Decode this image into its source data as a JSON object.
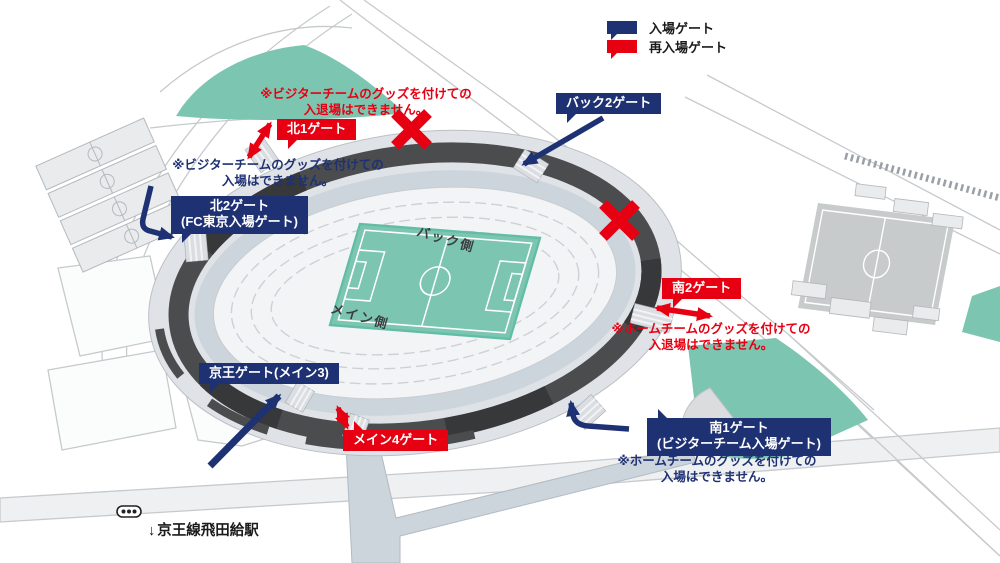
{
  "legend": {
    "entry": "入場ゲート",
    "reentry": "再入場ゲート"
  },
  "gates": {
    "north1": {
      "label": "北1ゲート"
    },
    "north2": {
      "label": "北2ゲート",
      "sublabel": "(FC東京入場ゲート)"
    },
    "back2": {
      "label": "バック2ゲート"
    },
    "south2": {
      "label": "南2ゲート"
    },
    "south1": {
      "label": "南1ゲート",
      "sublabel": "(ビジターチーム入場ゲート)"
    },
    "keio": {
      "label": "京王ゲート(メイン3)"
    },
    "main4": {
      "label": "メイン4ゲート"
    }
  },
  "warnings": {
    "visitor_reentry": {
      "line1": "※ビジターチームのグッズを付けての",
      "line2": "入退場はできません。"
    },
    "visitor_entry": {
      "line1": "※ビジターチームのグッズを付けての",
      "line2": "入場はできません。"
    },
    "home_reentry": {
      "line1": "※ホームチームのグッズを付けての",
      "line2": "入退場はできません。"
    },
    "home_entry": {
      "line1": "※ホームチームのグッズを付けての",
      "line2": "入場はできません。"
    }
  },
  "stadium": {
    "back_side": "バック側",
    "main_side": "メイン側"
  },
  "station": {
    "arrow": "↓",
    "label": "京王線飛田給駅"
  },
  "colors": {
    "navy": "#1e3173",
    "red": "#e60012",
    "pitch_green": "#7cc6b1",
    "ring_dark": "#4b4c4e"
  }
}
